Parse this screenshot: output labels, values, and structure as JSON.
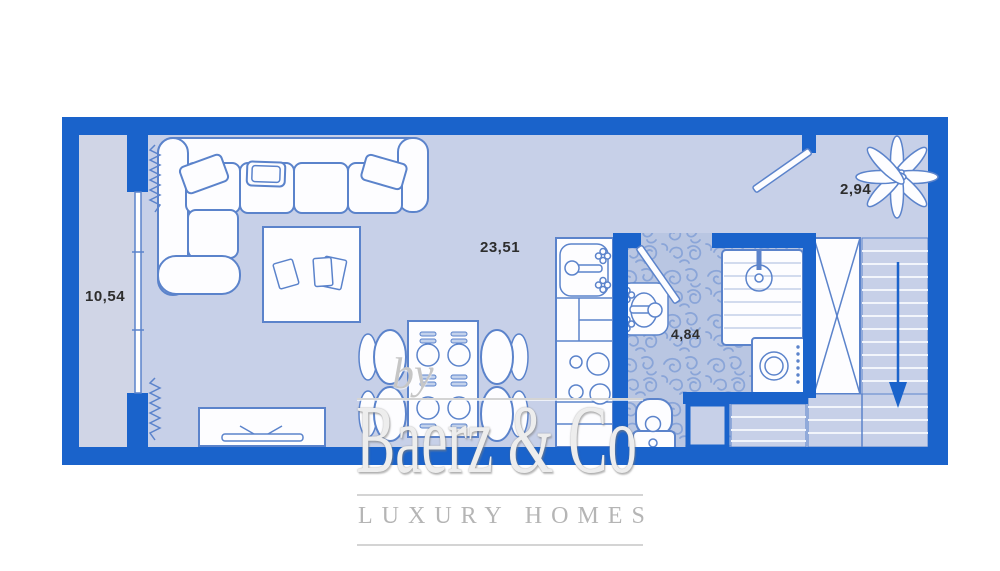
{
  "rooms": {
    "balcony": {
      "label": "10,54"
    },
    "living_room": {
      "label": "23,51"
    },
    "bathroom": {
      "label": "4,84"
    },
    "hall": {
      "label": "2,94"
    }
  },
  "watermark": {
    "by": "by",
    "brand": "Baerz & Co",
    "tagline": "LUXURY HOMES"
  },
  "plan_elements": [
    "sofa-icon",
    "pillow-icon",
    "coffee-table-icon",
    "tv-stand-icon",
    "dining-table-icon",
    "dining-chair-icon",
    "kitchen-sink-icon",
    "cooktop-icon",
    "washbasin-icon",
    "shower-icon",
    "washing-machine-icon",
    "toilet-icon",
    "wardrobe-icon",
    "staircase-icon",
    "stair-arrow-icon",
    "entrance-door-icon",
    "bathroom-door-icon",
    "window-icon",
    "curtain-icon",
    "plant-icon",
    "shaft-icon"
  ],
  "colors": {
    "wall": "#1a63cb",
    "floor": "#c7d0e8",
    "balcony_floor": "#d0d5e6",
    "outline": "#5b83cb",
    "furniture_fill": "#fdfdff",
    "tile_base": "#b9c6e2",
    "tile_swirl": "#8aa5d8",
    "label_text": "#2d2d2d",
    "watermark_gray": "#bfbfbf",
    "background": "#ffffff"
  }
}
